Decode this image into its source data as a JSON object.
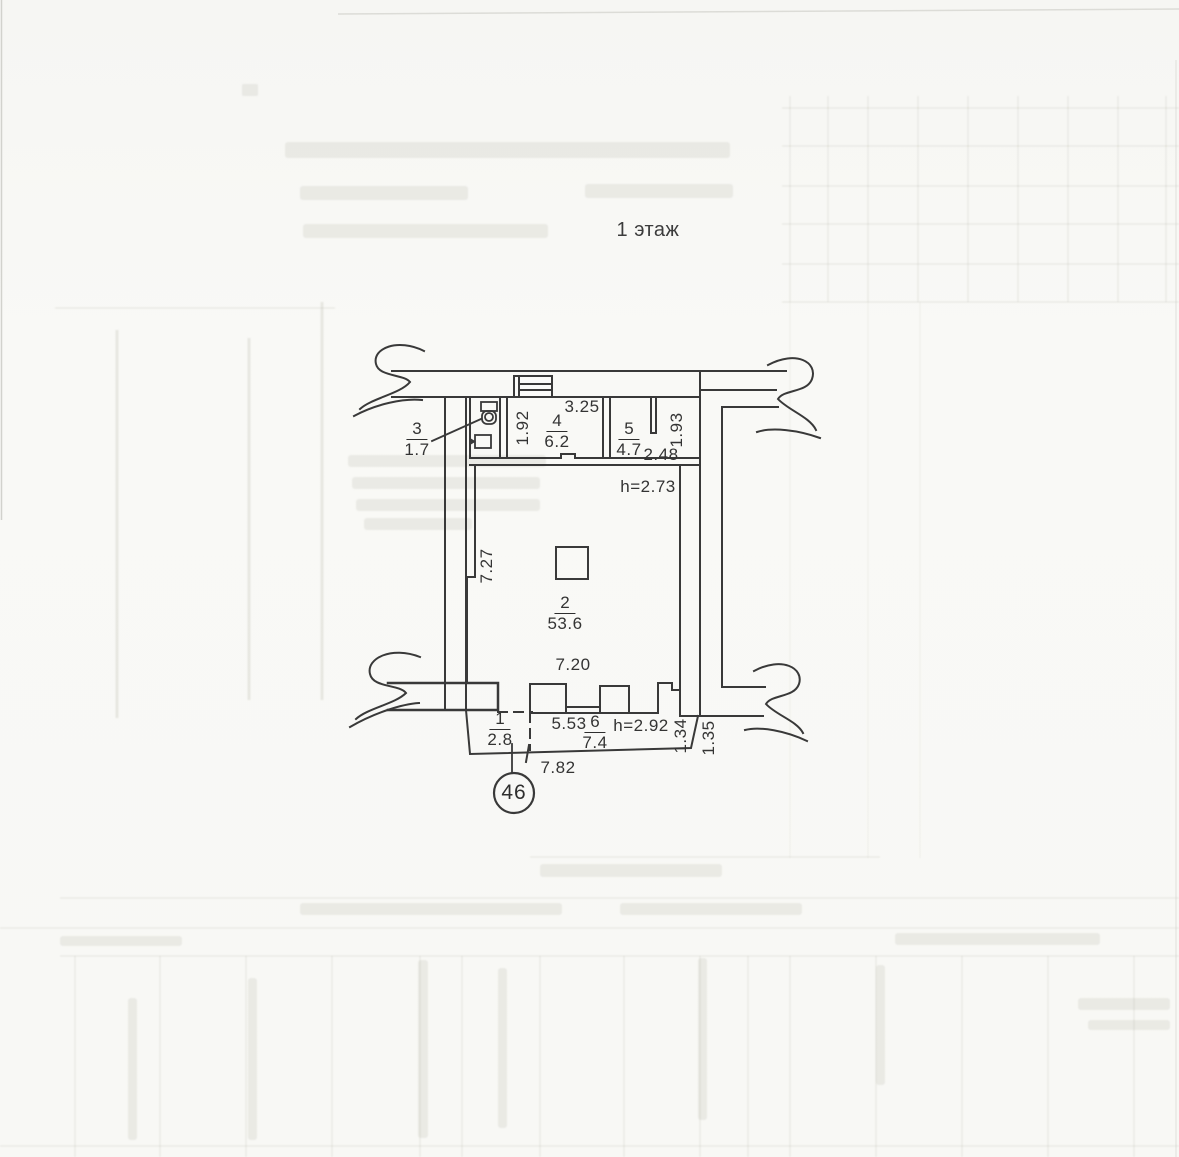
{
  "document": {
    "floor_title": "1 этаж",
    "apartment_badge": "46"
  },
  "rooms": {
    "r1": {
      "number": "1",
      "area": "2.8"
    },
    "r2": {
      "number": "2",
      "area": "53.6"
    },
    "r3": {
      "number": "3",
      "area": "1.7"
    },
    "r4": {
      "number": "4",
      "area": "6.2"
    },
    "r5": {
      "number": "5",
      "area": "4.7"
    },
    "r6": {
      "number": "6",
      "area": "7.4"
    }
  },
  "dimensions": {
    "d325": "3.25",
    "d192": "1.92",
    "d248": "2.48",
    "d193": "1.93",
    "d727": "7.27",
    "d720": "7.20",
    "d553": "5.53",
    "d782": "7.82",
    "d134": "1.34",
    "d135": "1.35",
    "h_main": "h=2.73",
    "h_entry": "h=2.92"
  }
}
